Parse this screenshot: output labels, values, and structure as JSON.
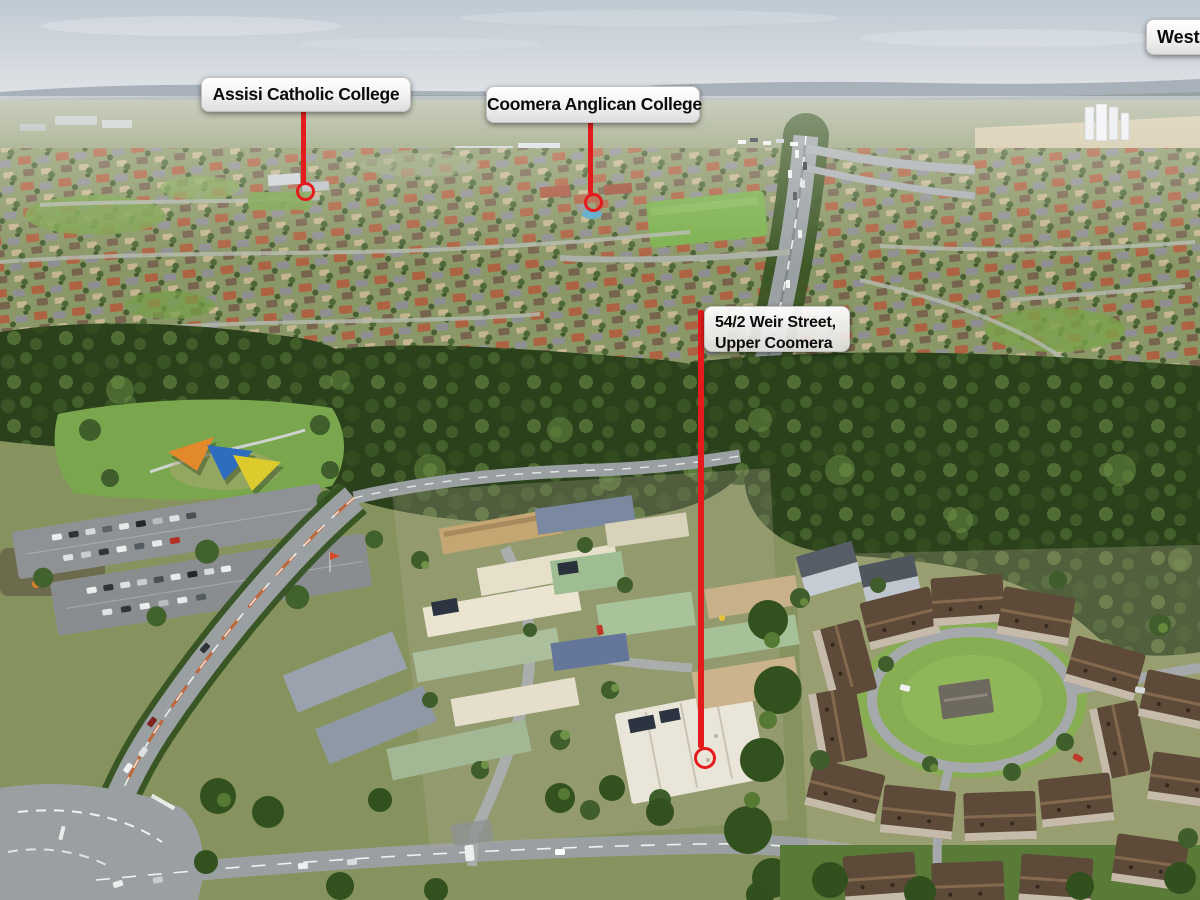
{
  "callouts": {
    "assisi": {
      "text": "Assisi Catholic College"
    },
    "coomera_anglican": {
      "text": "Coomera Anglican College"
    },
    "property": {
      "line1": "54/2 Weir Street,",
      "line2": "Upper Coomera"
    },
    "westfield": {
      "text": "Westfie"
    }
  },
  "marker": {
    "color": "#e41b1c"
  },
  "label_style": {
    "text_color": "#0c0c0c",
    "bg_top": "#ffffff",
    "bg_bottom": "#dedede"
  }
}
